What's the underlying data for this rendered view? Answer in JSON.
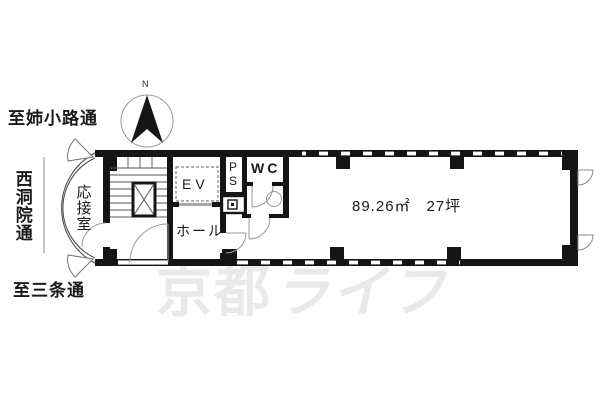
{
  "doc_type": "floor-plan",
  "colors": {
    "wall": "#151515",
    "thin_line": "#777777",
    "door_line": "#9a9a9a",
    "watermark": "#e9e9e8",
    "background": "#ffffff"
  },
  "labels": {
    "street_top": "至姉小路通",
    "street_left": "西洞院通",
    "street_bottom": "至三条通",
    "compass_north": "N",
    "reception_room": "応接室",
    "elevator": "EV",
    "pipe_space": "PS",
    "toilet": "WC",
    "hall": "ホール",
    "floor_area": "89.26㎡　27坪"
  },
  "watermark": {
    "part1": "京都",
    "part2": "ライフ"
  }
}
